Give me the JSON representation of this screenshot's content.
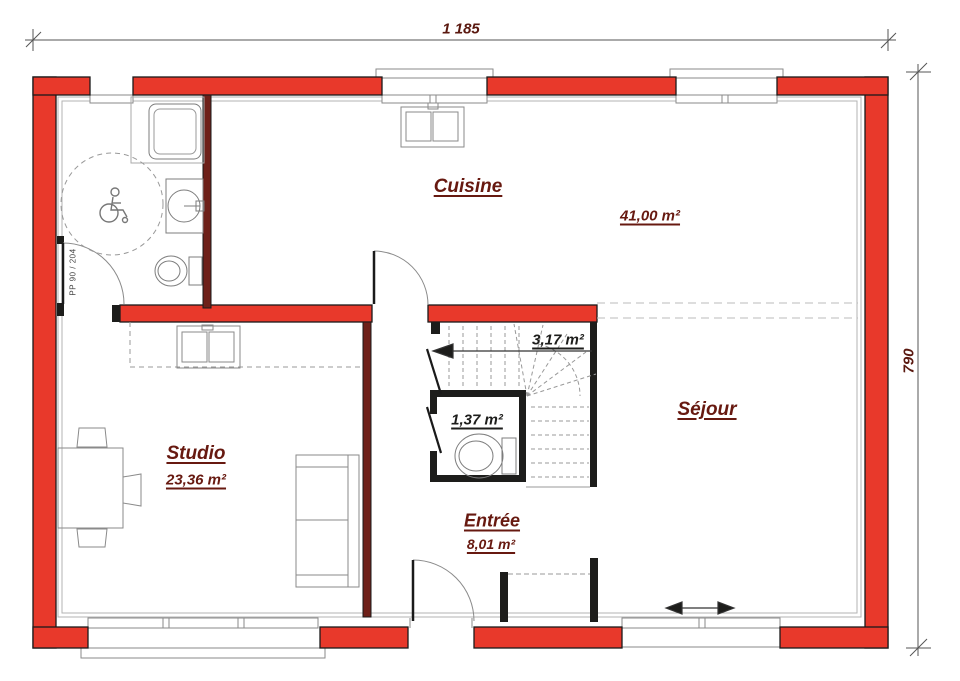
{
  "drawing": {
    "type": "floor-plan",
    "dimensions": {
      "width_label": "1 185",
      "height_label": "790"
    },
    "rooms": [
      {
        "name": "Cuisine",
        "area": "41,00 m²"
      },
      {
        "name": "Séjour",
        "area": ""
      },
      {
        "name": "Studio",
        "area": "23,36 m²"
      },
      {
        "name": "Entrée",
        "area": "8,01 m²"
      },
      {
        "name": "",
        "area": "3,17 m²"
      },
      {
        "name": "",
        "area": "1,37 m²"
      }
    ],
    "door_spec": "PP 90 / 204",
    "colors": {
      "exterior_wall": "#E8392B",
      "interior_wall": "#6E2019",
      "partition": "#1D1D1B",
      "room_label": "#671910",
      "area_label_dark": "#1D1D1B",
      "dimension_label": "#5A180F"
    },
    "fixtures": [
      "shower",
      "accessible-turning-circle",
      "washbasin",
      "toilet",
      "kitchen-sink",
      "counter-sink",
      "winder-stairs",
      "wc-toilet",
      "entry-door",
      "sliding-bay",
      "wardrobe",
      "table",
      "chairs",
      "sofa"
    ]
  }
}
